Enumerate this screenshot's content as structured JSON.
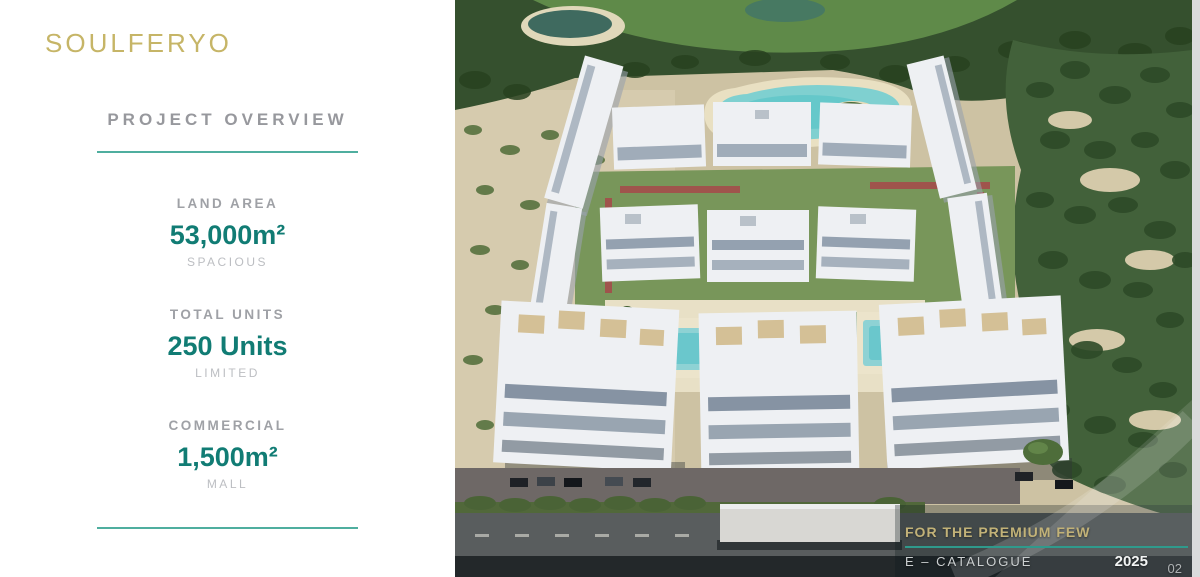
{
  "panel": {
    "logo": "SOULFERYO",
    "heading": "PROJECT OVERVIEW",
    "stats": [
      {
        "label": "LAND AREA",
        "value": "53,000m²",
        "sub": "SPACIOUS"
      },
      {
        "label": "TOTAL UNITS",
        "value": "250 Units",
        "sub": "LIMITED"
      },
      {
        "label": "COMMERCIAL",
        "value": "1,500m²",
        "sub": "MALL"
      }
    ]
  },
  "footer": {
    "tagline": "FOR THE PREMIUM FEW",
    "catalogue": "E – CATALOGUE",
    "year": "2025",
    "page": "02"
  },
  "colors": {
    "accent_teal": "#4fae9f",
    "brand_gold": "#c6b567",
    "stat_green": "#117c74",
    "footer_line_teal": "#2f9a8c"
  }
}
